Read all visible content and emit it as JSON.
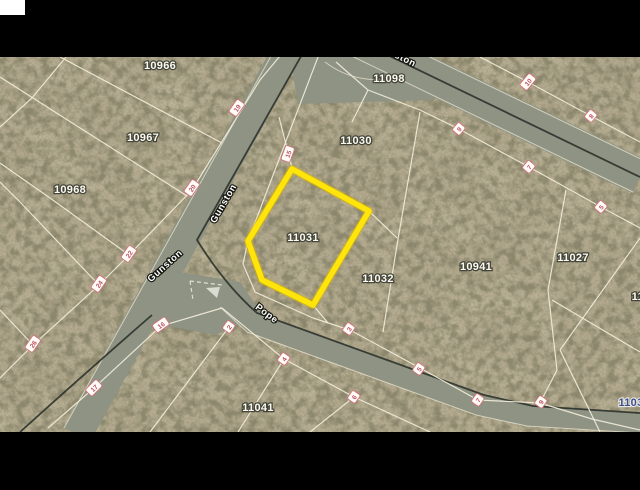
{
  "map": {
    "description": "Aerial parcel map with highlighted lot",
    "highlight_color": "#ffe50a",
    "terrain_color": "#b2a98e",
    "road_color": "#8e9383",
    "parcel_line_color": "#f1ebd8",
    "chip_text_color": "#bf4f63",
    "highlight_parcel": {
      "id": "11031",
      "points": "292,169 369,211 313,305 262,280 248,241"
    },
    "parcel_labels": [
      {
        "text": "10966",
        "x": 160,
        "y": 69
      },
      {
        "text": "10967",
        "x": 143,
        "y": 141
      },
      {
        "text": "10968",
        "x": 70,
        "y": 193
      },
      {
        "text": "11098",
        "x": 389,
        "y": 82
      },
      {
        "text": "11030",
        "x": 356,
        "y": 144
      },
      {
        "text": "11031",
        "x": 303,
        "y": 241
      },
      {
        "text": "11032",
        "x": 378,
        "y": 282
      },
      {
        "text": "10941",
        "x": 476,
        "y": 270
      },
      {
        "text": "11027",
        "x": 573,
        "y": 261
      },
      {
        "text": "11041",
        "x": 258,
        "y": 411
      },
      {
        "text": "110",
        "x": 641,
        "y": 300,
        "anchor": "middle"
      },
      {
        "text": "1103",
        "x": 631,
        "y": 406,
        "style": "dark"
      }
    ],
    "street_labels": [
      {
        "text": "Gunston",
        "x": 226,
        "y": 205,
        "rotate": -60
      },
      {
        "text": "Gunston",
        "x": 167,
        "y": 268,
        "rotate": -42
      },
      {
        "text": "Pope",
        "x": 265,
        "y": 316,
        "rotate": 37
      },
      {
        "text": "ston",
        "x": 404,
        "y": 62,
        "rotate": 26
      }
    ],
    "lot_chips": [
      {
        "text": "19",
        "x": 237,
        "y": 108,
        "rotate": -55
      },
      {
        "text": "20",
        "x": 192,
        "y": 188,
        "rotate": -55
      },
      {
        "text": "22",
        "x": 129,
        "y": 254,
        "rotate": -55
      },
      {
        "text": "24",
        "x": 99,
        "y": 284,
        "rotate": -55
      },
      {
        "text": "26",
        "x": 33,
        "y": 344,
        "rotate": -55
      },
      {
        "text": "15",
        "x": 288,
        "y": 154,
        "rotate": -70
      },
      {
        "text": "16",
        "x": 161,
        "y": 325,
        "rotate": -35
      },
      {
        "text": "17",
        "x": 94,
        "y": 388,
        "rotate": -45
      },
      {
        "text": "10",
        "x": 528,
        "y": 82,
        "rotate": -50
      },
      {
        "text": "8",
        "x": 591,
        "y": 116,
        "rotate": -50
      },
      {
        "text": "9",
        "x": 459,
        "y": 129,
        "rotate": -50
      },
      {
        "text": "7",
        "x": 529,
        "y": 167,
        "rotate": -50
      },
      {
        "text": "5",
        "x": 601,
        "y": 207,
        "rotate": -50
      },
      {
        "text": "2",
        "x": 229,
        "y": 327,
        "rotate": -55
      },
      {
        "text": "4",
        "x": 284,
        "y": 359,
        "rotate": -55
      },
      {
        "text": "6",
        "x": 354,
        "y": 397,
        "rotate": -55
      },
      {
        "text": "3",
        "x": 349,
        "y": 329,
        "rotate": -55
      },
      {
        "text": "5",
        "x": 419,
        "y": 369,
        "rotate": -55
      },
      {
        "text": "7",
        "x": 478,
        "y": 400,
        "rotate": -55
      },
      {
        "text": "9",
        "x": 541,
        "y": 402,
        "rotate": -55
      }
    ]
  }
}
